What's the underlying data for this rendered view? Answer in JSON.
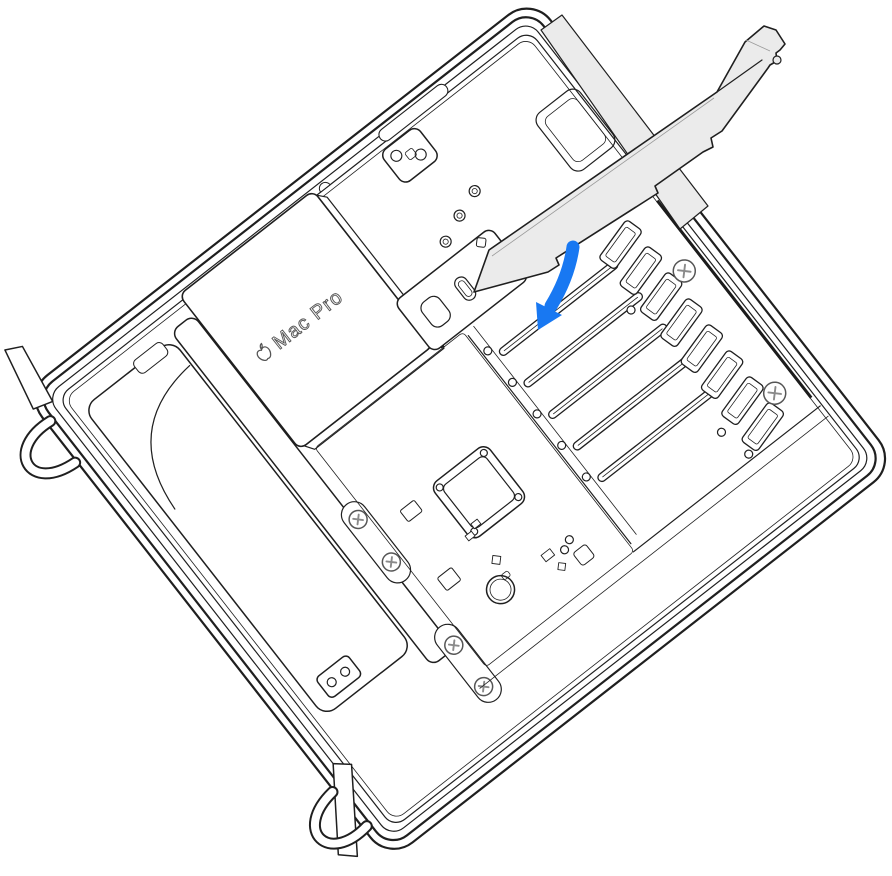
{
  "illustration": {
    "device_label": "Mac Pro",
    "description": "Line illustration of a Mac Pro lying on its side with the housing removed, a PCIe card held above the expansion bay and a blue arrow showing it being inserted into a PCIe slot.",
    "pcie_slot_count": 5,
    "slot_cover_count": 8,
    "retention_screw_count": 2,
    "board_screw_count": 4
  },
  "colors": {
    "line": "#1f1f1f",
    "softline": "#4d4d4d",
    "cardfill": "#ebebeb",
    "arrow": "#1878f2",
    "bg": "#ffffff"
  }
}
